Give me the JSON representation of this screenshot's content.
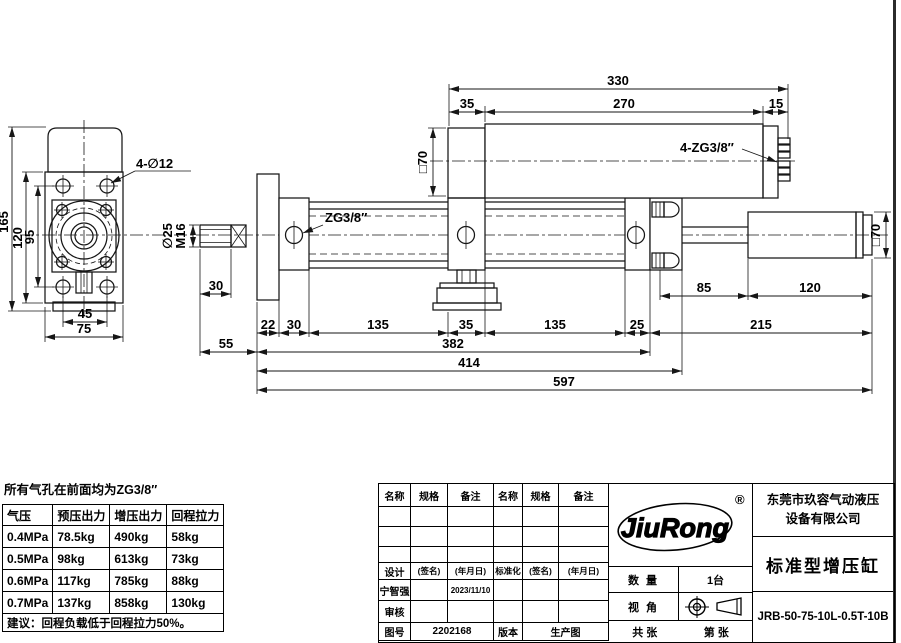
{
  "drawing": {
    "labels": {
      "holes": "4-∅12",
      "rod_dia": "∅25",
      "rod_thread": "M16",
      "port": "ZG3/8″",
      "booster_ports": "4-ZG3/8″",
      "booster_square": "□70",
      "output_square": "□70"
    },
    "dims": {
      "front": {
        "height": "165",
        "plate_height": "120",
        "hole_span_v": "95",
        "hole_span_h": "45",
        "plate_width": "75"
      },
      "rod": {
        "thread_len": "30",
        "protrusion": "55"
      },
      "top": {
        "total": "330",
        "left": "35",
        "body": "270",
        "right": "15"
      },
      "bottom_chain": [
        "22",
        "30",
        "135",
        "35",
        "135",
        "25",
        "215"
      ],
      "bottom": {
        "d85": "85",
        "d120": "120",
        "d382": "382",
        "d414": "414",
        "d597": "597"
      }
    }
  },
  "force_table": {
    "note_top": "所有气孔在前面均为ZG3/8″",
    "headers": [
      "气压",
      "预压出力",
      "增压出力",
      "回程拉力"
    ],
    "rows": [
      [
        "0.4MPa",
        "78.5kg",
        "490kg",
        "58kg"
      ],
      [
        "0.5MPa",
        "98kg",
        "613kg",
        "73kg"
      ],
      [
        "0.6MPa",
        "117kg",
        "785kg",
        "88kg"
      ],
      [
        "0.7MPa",
        "137kg",
        "858kg",
        "130kg"
      ]
    ],
    "note_bottom": "建议：回程负载低于回程拉力50%。"
  },
  "title_block": {
    "parts_headers": [
      "名称",
      "规格",
      "备注",
      "名称",
      "规格",
      "备注"
    ],
    "sign": {
      "design_label": "设计",
      "sign_hint": "(签名)",
      "date_hint": "(年月日)",
      "standard_label": "标准化",
      "designer": "宁智强",
      "design_date": "2023/11/10",
      "check_label": "审核"
    },
    "doc": {
      "no_label": "图号",
      "no": "2202168",
      "ver_label": "版本",
      "ver": "生产图"
    },
    "brand": {
      "text": "JiuRong",
      "reg": "®"
    },
    "company_line1": "东莞市玖容气动液压",
    "company_line2": "设备有限公司",
    "product": "标准型增压缸",
    "qty_label": "数 量",
    "qty": "1台",
    "view_label": "视 角",
    "sheets_total_label": "共 张",
    "sheet_no_label": "第 张",
    "model": "JRB-50-75-10L-0.5T-10B"
  }
}
